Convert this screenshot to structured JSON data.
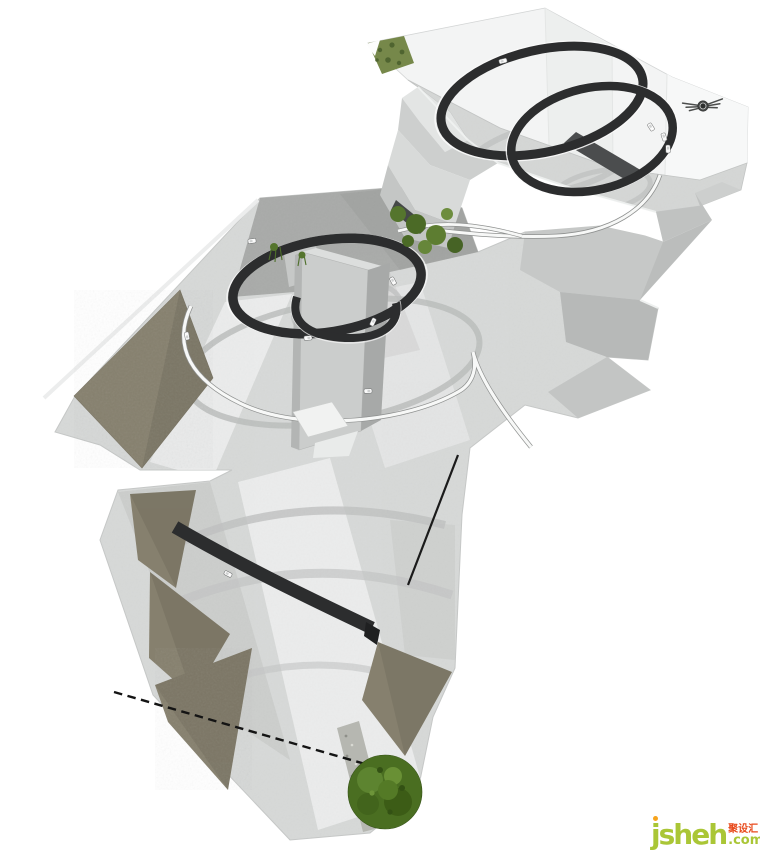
{
  "page": {
    "width": 760,
    "height": 857,
    "background": "#ffffff"
  },
  "watermark": {
    "brand": "jsheh",
    "suffix": ".com",
    "chinese": "聚设汇",
    "brand_color": "#aac636",
    "suffix_color": "#aac636",
    "chinese_color": "#e84a1c",
    "dot_color": "#f7a41d"
  },
  "model": {
    "colors": {
      "track": "#2c2d2e",
      "canopy_wall": "#f3f4f4",
      "concrete_light": "#d7d9d8",
      "concrete_mid": "#c3c5c4",
      "concrete_dark": "#a9aba9",
      "earth_wall": "#86806e",
      "vegetation": "#55752d",
      "tree": "#4a6e21",
      "ribbon": "#f7f8f7",
      "walkway": "#4b4d4e",
      "emblem": "#454746"
    },
    "cars": [
      [
        503,
        61,
        -15
      ],
      [
        651,
        127,
        58
      ],
      [
        664,
        137,
        72
      ],
      [
        668,
        149,
        88
      ],
      [
        252,
        241,
        -8
      ],
      [
        393,
        281,
        62
      ],
      [
        373,
        322,
        115
      ],
      [
        308,
        338,
        176
      ],
      [
        187,
        336,
        -100
      ],
      [
        368,
        391,
        178
      ],
      [
        228,
        574,
        27
      ]
    ]
  }
}
